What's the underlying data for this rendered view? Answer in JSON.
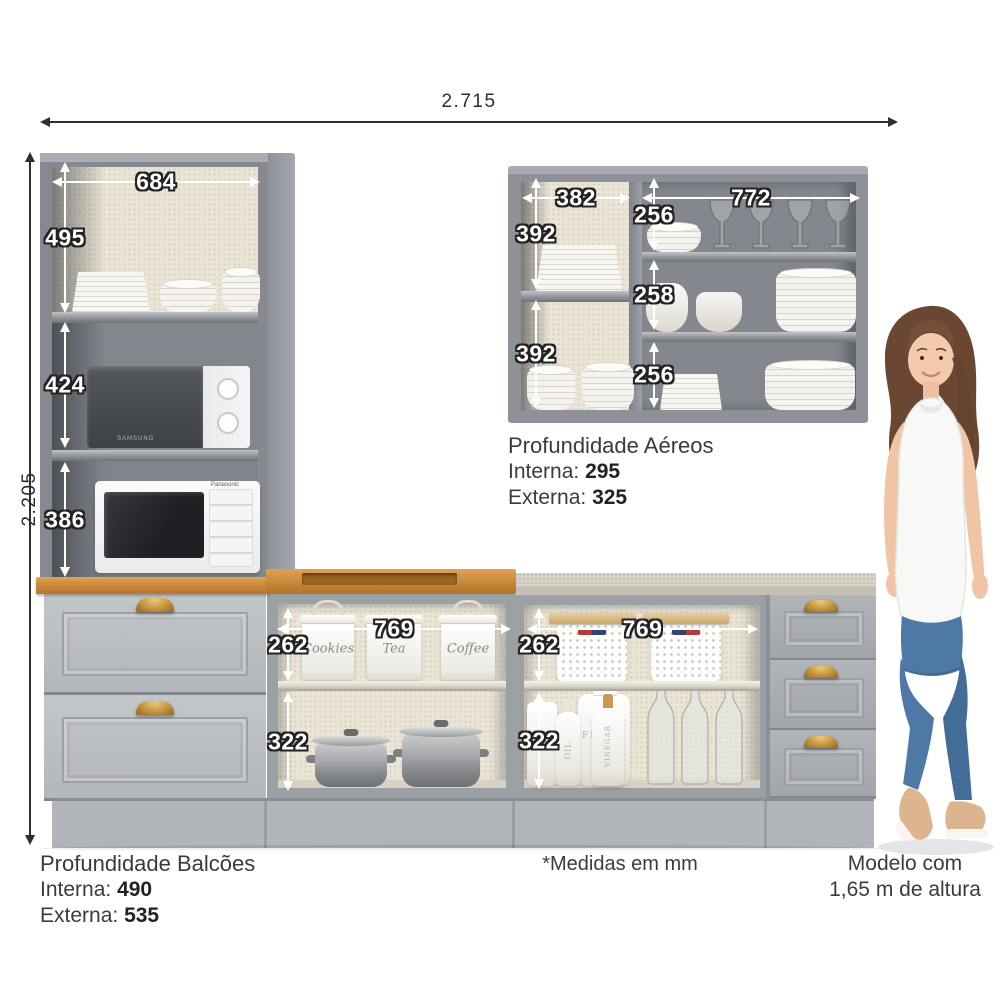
{
  "page": {
    "type": "product-dimensions-diagram",
    "footnote": "*Medidas em mm"
  },
  "dims": {
    "overall_width": "2.715",
    "overall_height": "2.205",
    "tall_width": "684",
    "tall_top": "495",
    "tall_middle": "424",
    "tall_bottom": "386",
    "wall_left_width": "382",
    "wall_right_width": "772",
    "wall_left_top": "392",
    "wall_left_bottom": "392",
    "wall_right_top": "256",
    "wall_right_middle": "258",
    "wall_right_bottom": "256",
    "center_width": "769",
    "center_upper": "262",
    "center_lower": "322",
    "right_width": "769",
    "right_upper": "262",
    "right_lower": "322"
  },
  "depth_wall_units": {
    "title": "Profundidade Aéreos",
    "interna_label": "Interna:",
    "interna_value": "295",
    "externa_label": "Externa:",
    "externa_value": "325"
  },
  "depth_base_units": {
    "title": "Profundidade Balcões",
    "interna_label": "Interna:",
    "interna_value": "490",
    "externa_label": "Externa:",
    "externa_value": "535"
  },
  "model_note": {
    "line1": "Modelo com",
    "line2": "1,65 m de altura"
  },
  "props": {
    "canister_1": "Cookies",
    "canister_2": "Tea",
    "canister_3": "Coffee",
    "jar_flour": "Flour",
    "jar_oil": "Oil",
    "jar_vinegar": "Vinegar",
    "microwave_upper_brand": "SAMSUNG",
    "microwave_lower_brand": "Panasonic"
  },
  "colors": {
    "cabinet_grey": "#8f9399",
    "drawer_grey": "#b6b9bd",
    "wood_counter": "#c98a3c",
    "gold_handle": "#c3923e",
    "linen_panel": "#ebe5d7",
    "stone_counter": "#d4d0c6",
    "denim": "#4e79a5"
  }
}
